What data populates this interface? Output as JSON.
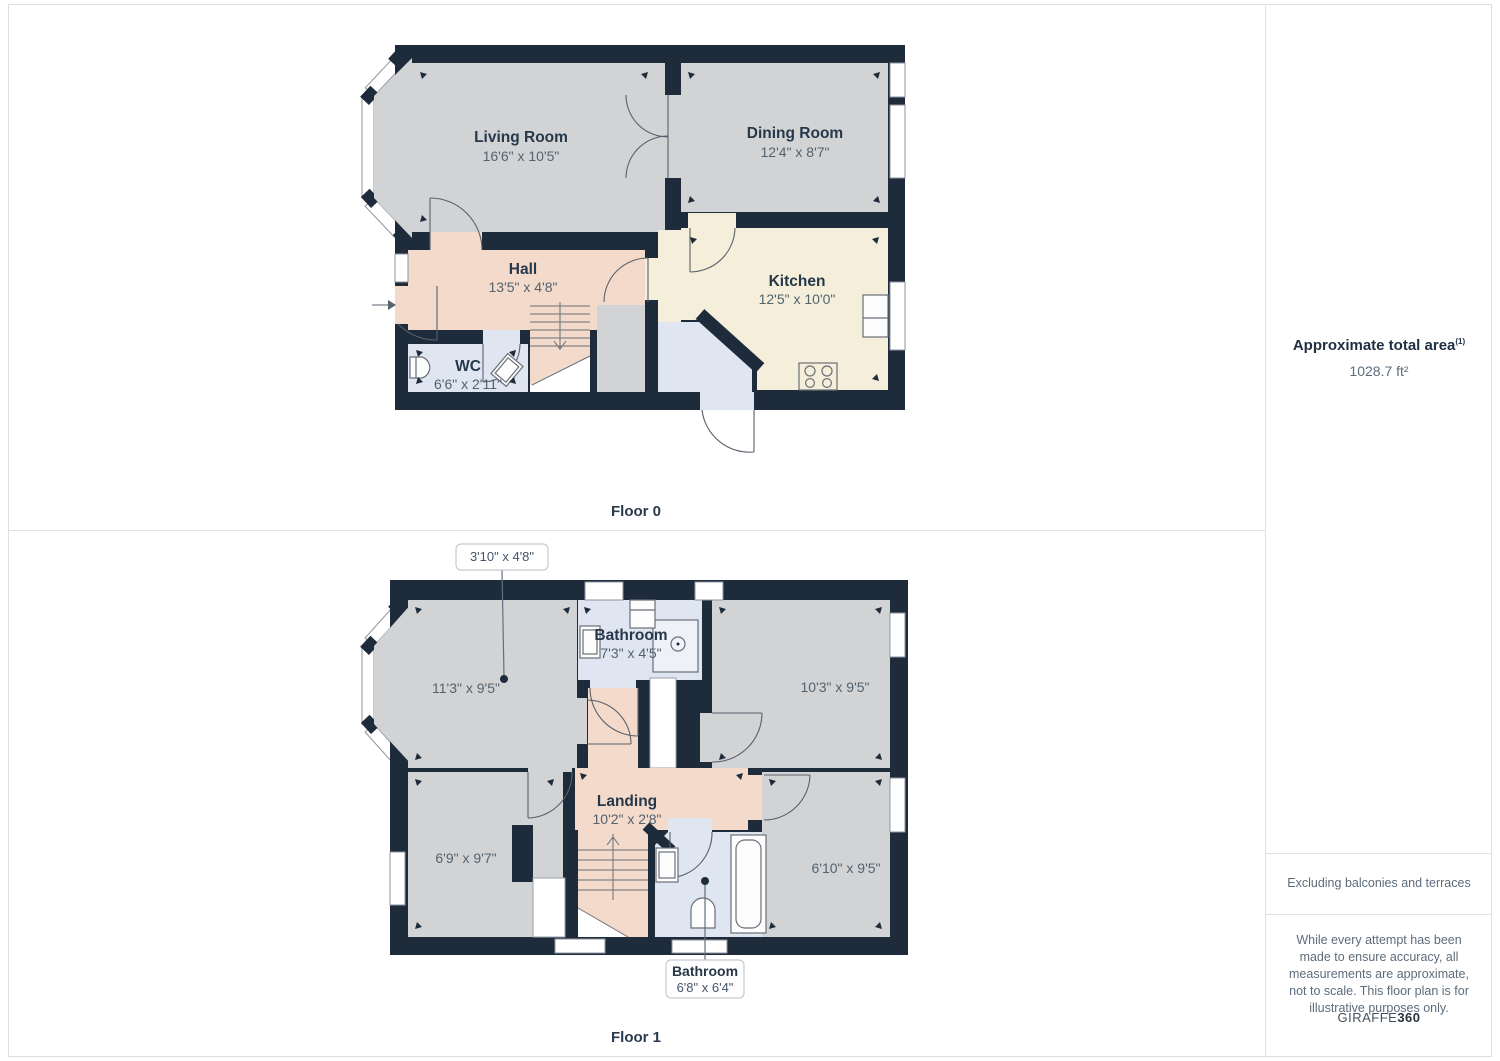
{
  "floor0": {
    "label": "Floor 0",
    "rooms": {
      "living": {
        "name": "Living Room",
        "dims": "16'6\" x 10'5\""
      },
      "dining": {
        "name": "Dining Room",
        "dims": "12'4\" x 8'7\""
      },
      "hall": {
        "name": "Hall",
        "dims": "13'5\" x 4'8\""
      },
      "kitchen": {
        "name": "Kitchen",
        "dims": "12'5\" x 10'0\""
      },
      "wc": {
        "name": "WC",
        "dims": "6'6\" x 2'11\""
      }
    }
  },
  "floor1": {
    "label": "Floor 1",
    "rooms": {
      "bedroom_front": {
        "dims": "11'3\" x 9'5\""
      },
      "bathroom_top": {
        "name": "Bathroom",
        "dims": "7'3\" x 4'5\""
      },
      "bedroom_right": {
        "dims": "10'3\" x 9'5\""
      },
      "landing": {
        "name": "Landing",
        "dims": "10'2\" x 2'8\""
      },
      "bedroom_back_left": {
        "dims": "6'9\" x 9'7\""
      },
      "bedroom_back_right": {
        "dims": "6'10\" x 9'5\""
      }
    },
    "callouts": {
      "small_room": {
        "dims": "3'10\" x 4'8\""
      },
      "bathroom": {
        "name": "Bathroom",
        "dims": "6'8\" x 6'4\""
      }
    }
  },
  "sidebar": {
    "total_area_label": "Approximate total area",
    "total_area_footnote": "(1)",
    "total_area_value": "1028.7 ft²",
    "excluding_note": "Excluding balconies and terraces",
    "disclaimer": "While every attempt has been made to ensure accuracy, all measurements are approximate, not to scale. This floor plan is for illustrative purposes only.",
    "brand_name": "GIRAFFE",
    "brand_suffix": "360"
  },
  "colors": {
    "wall": "#1e2b3a",
    "room-gray": "#d2d3d5",
    "room-peach": "#f3dacb",
    "room-cream": "#f4eeda",
    "room-blue": "#dfe5f1",
    "label": "#26384a",
    "dims": "#52636f",
    "line": "#5a616c"
  }
}
